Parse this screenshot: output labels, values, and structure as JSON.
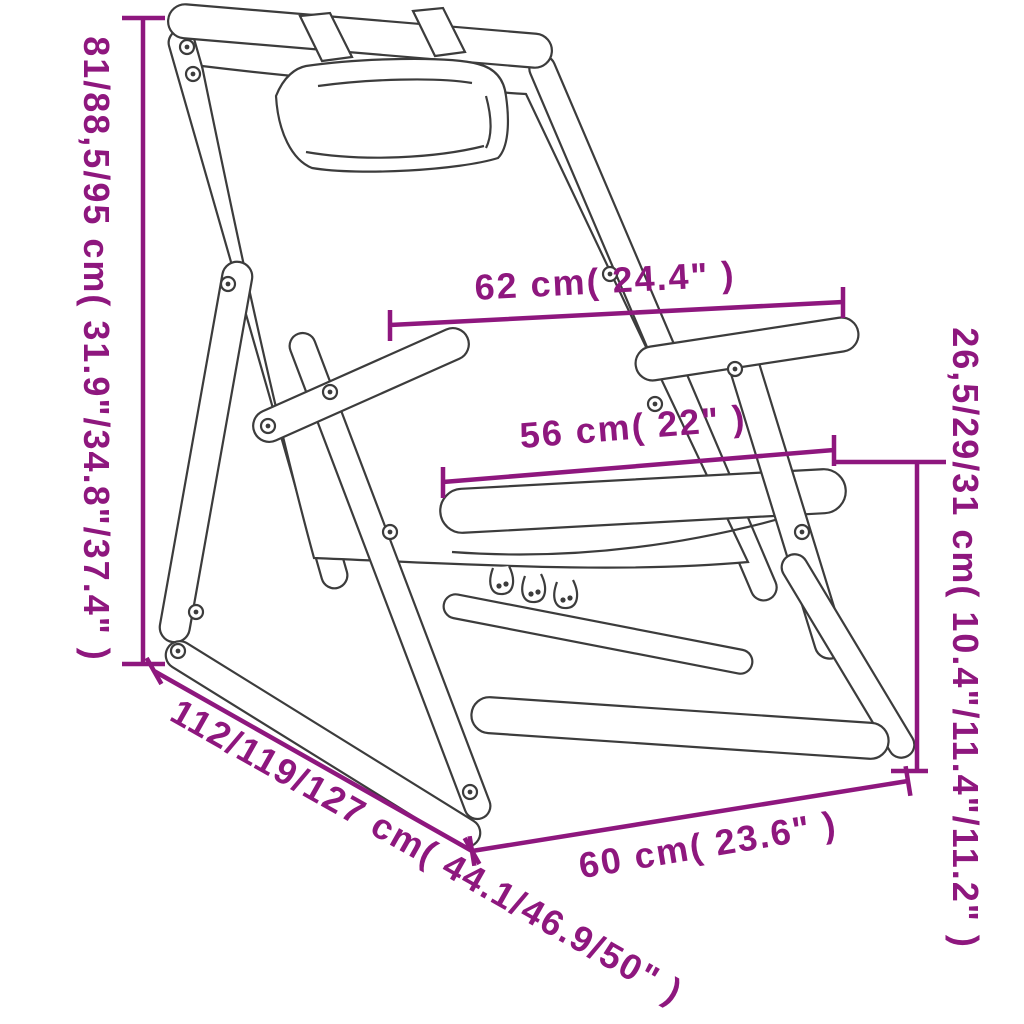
{
  "illustration": {
    "title": "folding-deck-chair-dimension-diagram",
    "subject": "wooden folding deck chair with headrest pillow"
  },
  "colors": {
    "dimension_text": "#8E177E",
    "line_art": "#3C3C3C",
    "background": "#FFFFFF"
  },
  "dimensions": {
    "back_height": "81/88,5/95 cm( 31.9\"/34.8\"/37.4\" )",
    "width_top": "62 cm( 24.4\" )",
    "width_seat": "56 cm( 22\" )",
    "seat_height": "26,5/29/31 cm( 10.4\"/11.4\"/11.2\" )",
    "depth_total": "112/119/127 cm( 44.1/46.9/50\" )",
    "width_base": "60 cm( 23.6\" )"
  }
}
